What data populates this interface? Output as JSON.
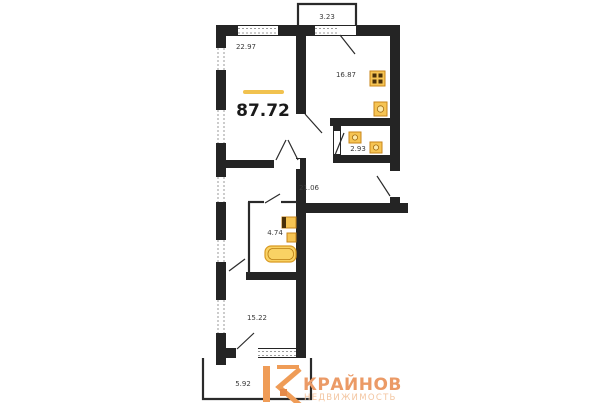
{
  "plan": {
    "total": {
      "area": "87.72"
    },
    "rooms": [
      {
        "id": "balcony-top",
        "area": "3.23"
      },
      {
        "id": "room-top-left",
        "area": "22.97"
      },
      {
        "id": "kitchen",
        "area": "16.87"
      },
      {
        "id": "wc",
        "area": "2.93"
      },
      {
        "id": "hallway",
        "area": "21.06"
      },
      {
        "id": "bathroom",
        "area": "4.74"
      },
      {
        "id": "room-bottom",
        "area": "15.22"
      },
      {
        "id": "balcony-bottom",
        "area": "5.92"
      }
    ],
    "fixtures": [
      "stove-icon",
      "kitchen-sink-icon",
      "toilet-icon",
      "boiler-icon",
      "washbasin-icon",
      "bathtub-icon"
    ]
  },
  "logo": {
    "name": "КРАЙНОВ",
    "subtitle": "НЕДВИЖИМОСТЬ"
  },
  "colors": {
    "wall": "#242424",
    "accent_line": "#f1c24f",
    "fixture": "#f6c453",
    "fixture_border": "#c8861a",
    "logo_primary": "#ef9c57",
    "logo_text": "#eb9a66",
    "logo_subtext": "#f3c5a0"
  }
}
